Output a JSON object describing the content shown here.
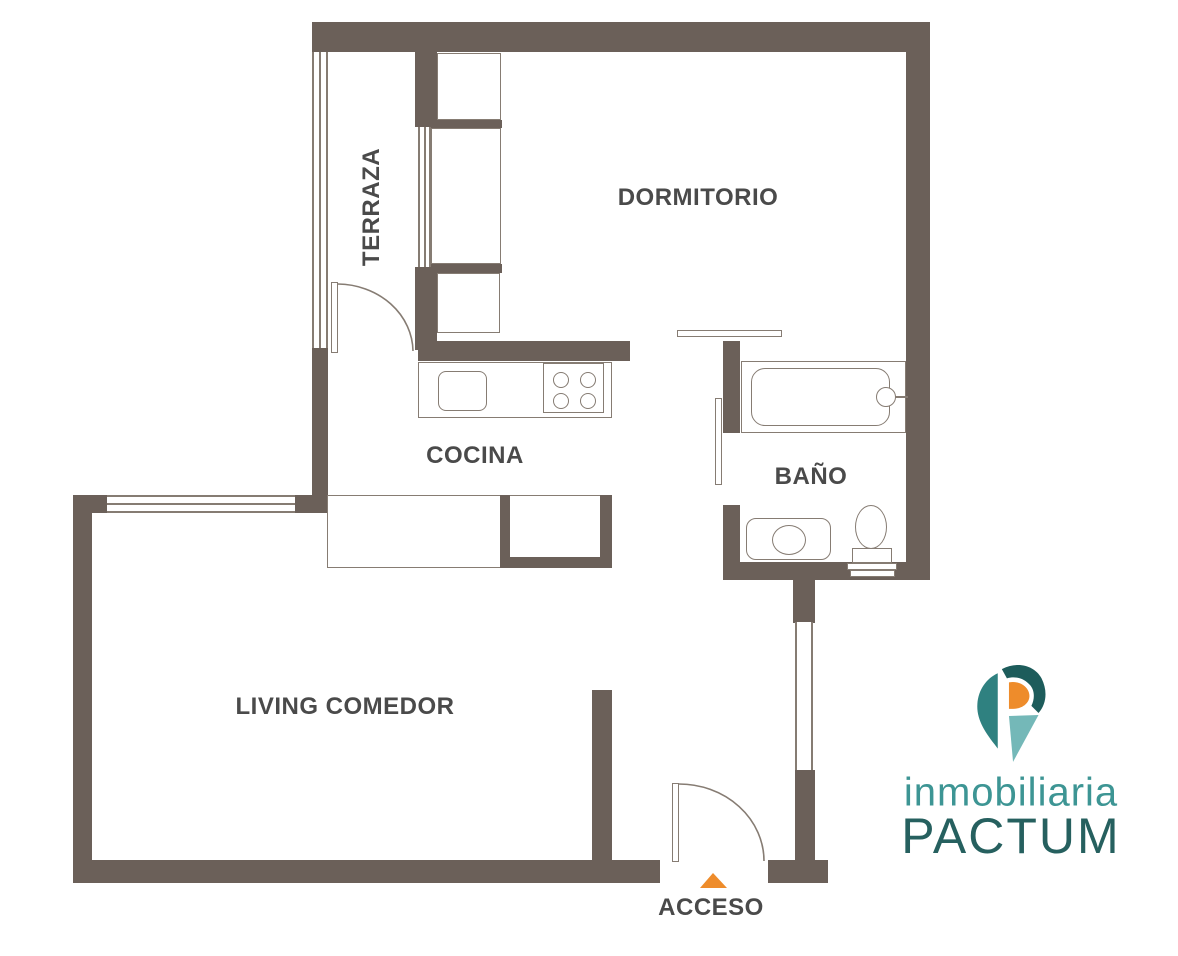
{
  "title": "Floor plan",
  "rooms": {
    "terraza": "TERRAZA",
    "dormitorio": "DORMITORIO",
    "cocina": "COCINA",
    "bano": "BAÑO",
    "living": "LIVING COMEDOR",
    "acceso": "ACCESO"
  },
  "logo": {
    "brand_line1": "inmobiliaria",
    "brand_line2": "PACTUM"
  },
  "colors": {
    "wall": "#6b6059",
    "thin_line": "#867c73",
    "label_text": "#4a4a4a",
    "access_arrow_orange": "#ee8c2b",
    "logo_teal_dark": "#1d5c5b",
    "logo_teal_mid": "#2f8180",
    "logo_teal_light": "#74b8b8",
    "logo_orange": "#ee8c2b",
    "logo_subtitle_teal": "#3d9594",
    "logo_title_teal": "#26605f"
  }
}
